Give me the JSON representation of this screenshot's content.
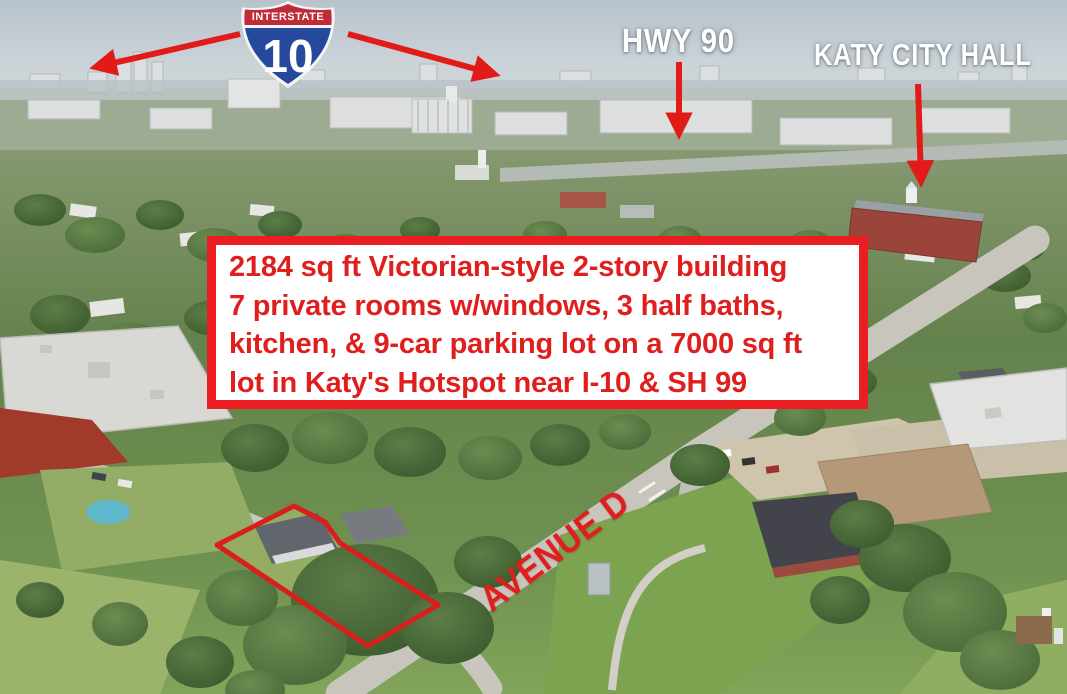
{
  "scene": {
    "type": "aerial-real-estate-photo",
    "location_hint": "Katy hotspot near I-10 & SH 99"
  },
  "annotations": {
    "interstate_shield": {
      "top_label": "INTERSTATE",
      "route_number": "10"
    },
    "hwy_label": "HWY 90",
    "city_hall_label": "KATY CITY HALL",
    "street_label": "AVENUE D",
    "description_box": {
      "line1": "2184 sq ft Victorian-style 2-story building",
      "line2": "7 private rooms w/windows, 3 half baths,",
      "line3": "kitchen, & 9-car parking lot on a 7000 sq ft",
      "line4": "lot in Katy's Hotspot near I-10 & SH 99"
    },
    "colors": {
      "annotation_red": "#e01b18",
      "box_border_red": "#ea1d22",
      "text_red": "#df1f1e",
      "label_white": "#ffffff",
      "shield_blue": "#25499c",
      "shield_red": "#bf2c37"
    }
  }
}
